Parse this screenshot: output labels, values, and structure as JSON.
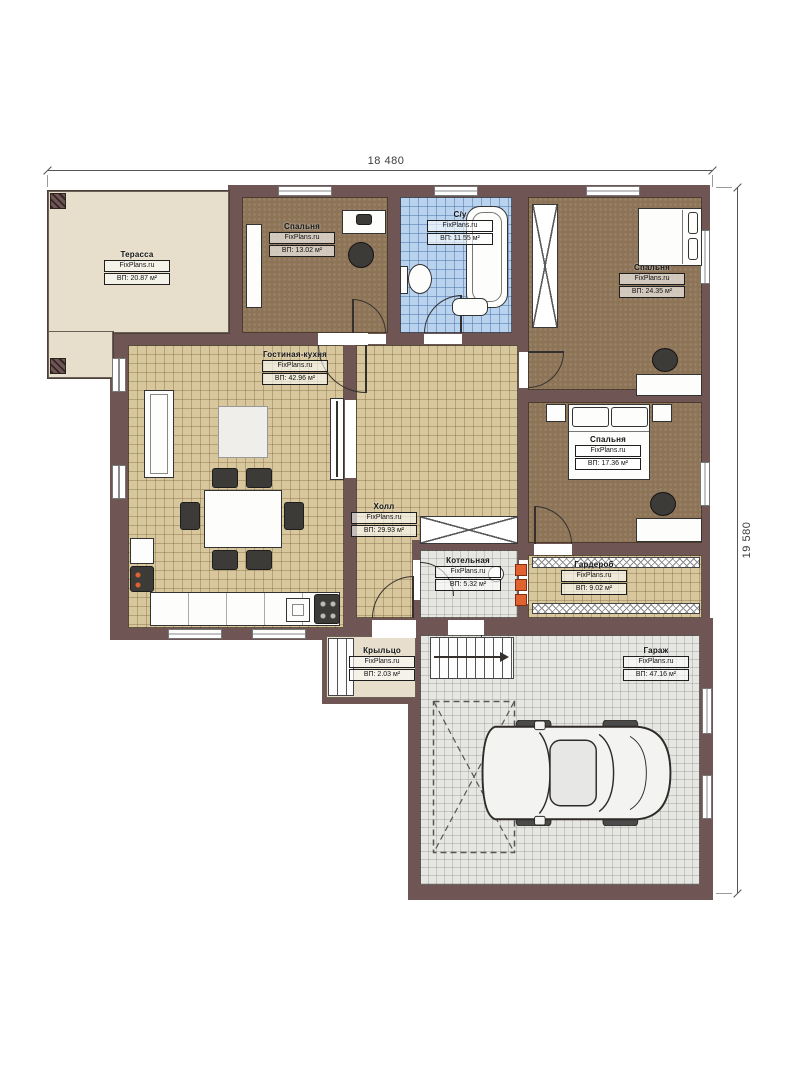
{
  "dimensions": {
    "top": "18 480",
    "right": "19 580"
  },
  "rooms": [
    {
      "id": "terrace",
      "name": "Терасса",
      "brand": "FixPlans.ru",
      "area": "ВП: 20.87 м²"
    },
    {
      "id": "bedroom1",
      "name": "Спальня",
      "brand": "FixPlans.ru",
      "area": "ВП: 13.02 м²"
    },
    {
      "id": "bathroom",
      "name": "С/у",
      "brand": "FixPlans.ru",
      "area": "ВП: 11.55 м²"
    },
    {
      "id": "bedroom2",
      "name": "Спальня",
      "brand": "FixPlans.ru",
      "area": "ВП: 24.35 м²"
    },
    {
      "id": "living",
      "name": "Гостиная-кухня",
      "brand": "FixPlans.ru",
      "area": "ВП: 42.96 м²"
    },
    {
      "id": "hall",
      "name": "Холл",
      "brand": "FixPlans.ru",
      "area": "ВП: 29.93 м²"
    },
    {
      "id": "bedroom3",
      "name": "Спальня",
      "brand": "FixPlans.ru",
      "area": "ВП: 17.36 м²"
    },
    {
      "id": "wardrobe",
      "name": "Гардероб",
      "brand": "FixPlans.ru",
      "area": "ВП: 9.02 м²"
    },
    {
      "id": "boiler",
      "name": "Котельная",
      "brand": "FixPlans.ru",
      "area": "ВП: 5.32 м²"
    },
    {
      "id": "porch",
      "name": "Крыльцо",
      "brand": "FixPlans.ru",
      "area": "ВП: 2.03 м²"
    },
    {
      "id": "garage",
      "name": "Гараж",
      "brand": "FixPlans.ru",
      "area": "ВП: 47.16 м²"
    }
  ],
  "colors": {
    "wall": "#6f5654",
    "floor_wood": "#d8c79c",
    "floor_bedroom": "#8d7457",
    "floor_tile_blue": "#b9d3ee",
    "floor_concrete": "#e6e6e3",
    "floor_terrace": "#e7decb",
    "accent_orange": "#e0622e"
  }
}
